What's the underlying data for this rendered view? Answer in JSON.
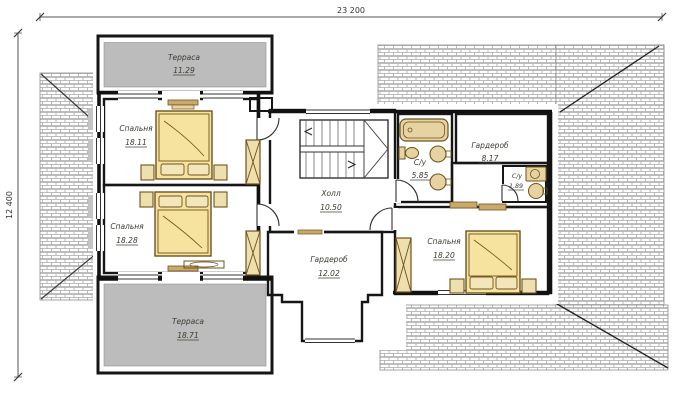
{
  "drawing": {
    "type": "architectural floor plan (second storey)",
    "dimension_labels": {
      "top_width": "23 200",
      "left_height": "12 400"
    },
    "rooms": {
      "terrace_top": {
        "name": "Терраса",
        "area": "11.29"
      },
      "bedroom_1": {
        "name": "Спальня",
        "area": "18.11"
      },
      "bedroom_2": {
        "name": "Спальня",
        "area": "18.28"
      },
      "terrace_bottom": {
        "name": "Терраса",
        "area": "18.71"
      },
      "hall": {
        "name": "Холл",
        "area": "10.50"
      },
      "bathroom_main": {
        "name": "С/у",
        "area": "5.85"
      },
      "wardrobe_right": {
        "name": "Гардероб",
        "area": "8.17"
      },
      "bathroom_small": {
        "name": "С/у",
        "area": "1.89"
      },
      "bedroom_3": {
        "name": "Спальня",
        "area": "18.20"
      },
      "wardrobe_center": {
        "name": "Гардероб",
        "area": "12.02"
      }
    },
    "colors": {
      "bedroom_fill": "#F3DA8E",
      "service_fill": "#CDB285",
      "terrace_fill": "#BCBCBC",
      "wall": "#161616",
      "furniture_line": "#6F531C",
      "roof_hatch_line": "#A8A8A8"
    }
  }
}
